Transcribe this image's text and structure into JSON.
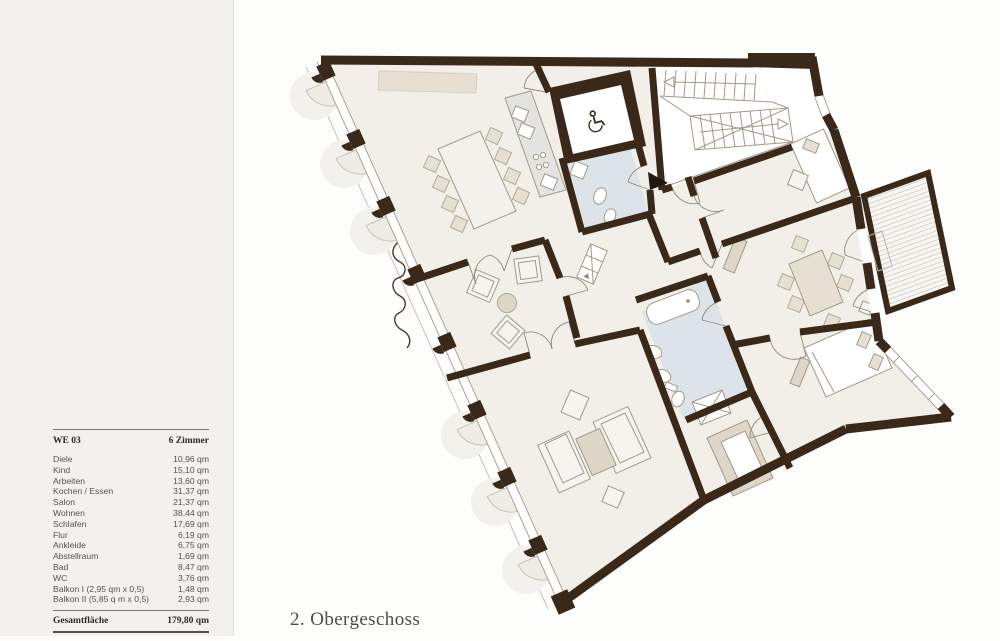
{
  "page": {
    "caption": "2. Obergeschoss"
  },
  "legend": {
    "header": {
      "unit": "WE 03",
      "rooms": "6 Zimmer"
    },
    "rows": [
      {
        "label": "Diele",
        "value": "10,96 qm"
      },
      {
        "label": "Kind",
        "value": "15,10 qm"
      },
      {
        "label": "Arbeiten",
        "value": "13,60 qm"
      },
      {
        "label": "Kochen / Essen",
        "value": "31,37 qm"
      },
      {
        "label": "Salon",
        "value": "21,37 qm"
      },
      {
        "label": "Wohnen",
        "value": "38,44 qm"
      },
      {
        "label": "Schlafen",
        "value": "17,69 qm"
      },
      {
        "label": "Flur",
        "value": "6,19 qm"
      },
      {
        "label": "Ankleide",
        "value": "6,75 qm"
      },
      {
        "label": "Abstellraum",
        "value": "1,69 qm"
      },
      {
        "label": "Bad",
        "value": "8,47 qm"
      },
      {
        "label": "WC",
        "value": "3,76 qm"
      },
      {
        "label": "Balkon I (2,95 qm x 0,5)",
        "value": "1,48 qm"
      },
      {
        "label": "Balkon II (5,85 q m x 0,5)",
        "value": "2,93 qm"
      }
    ],
    "total": {
      "label": "Gesamtfläche",
      "value": "179,80 qm"
    }
  },
  "theme": {
    "left-bg": "#f2f1ef",
    "page-bg": "#fdfdfc",
    "wall": "#3a2918",
    "room": "#f1efe8",
    "bath": "#dce4e9",
    "furn": "#e7e0d2",
    "furn-dark": "#ded6c6",
    "line": "#a29988",
    "thin": "#8f8779",
    "deck-stripe": "#b9b2a8",
    "decor": "#efece6",
    "decor-line": "#c9c1b4",
    "text": "#57524b",
    "text-dark": "#2e2a25",
    "rule": "#7c766c",
    "counter": "#e3e4e2"
  }
}
